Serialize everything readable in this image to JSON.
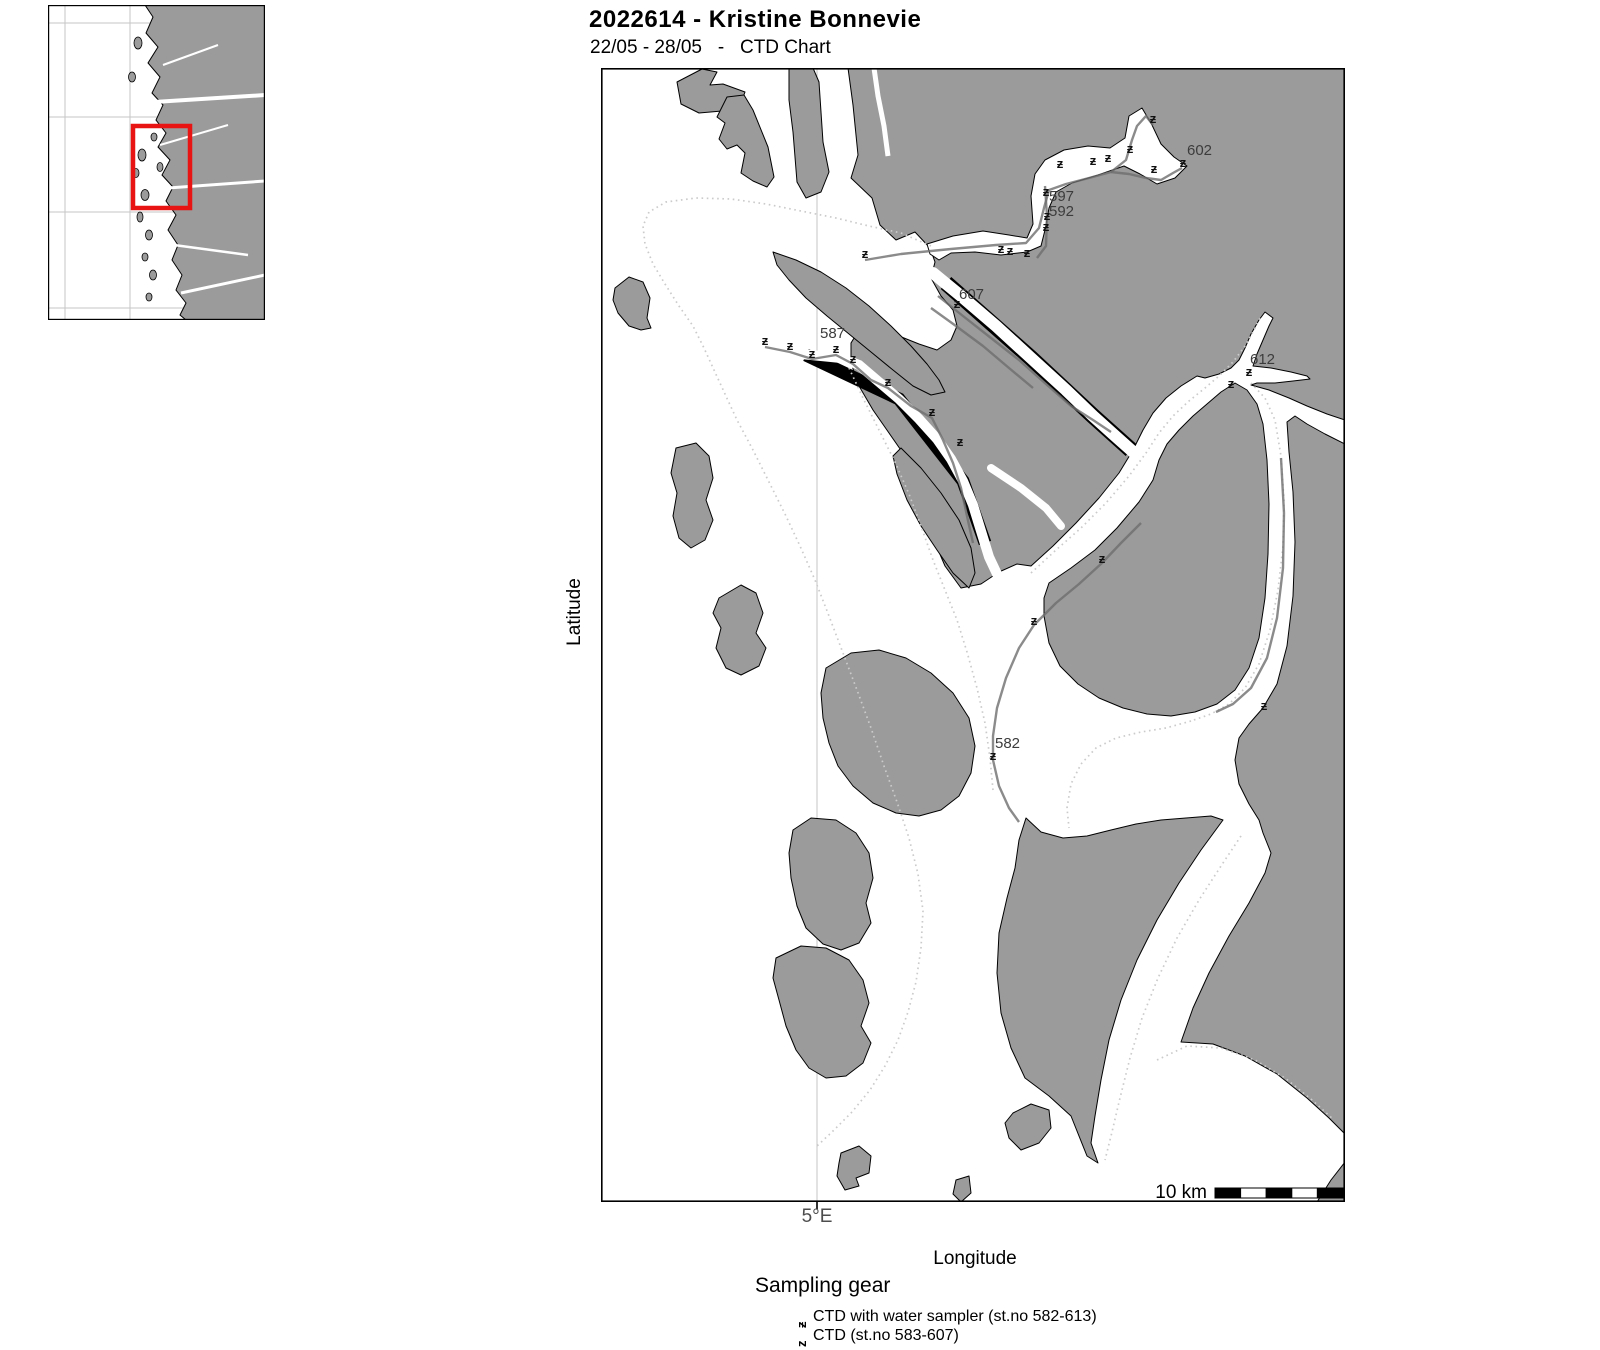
{
  "header": {
    "title": "2022614 - Kristine Bonnevie",
    "subtitle": "22/05 - 28/05   -   CTD Chart"
  },
  "axes": {
    "y_label": "Latitude",
    "x_label": "Longitude",
    "x_tick": "5°E"
  },
  "scale_bar": {
    "label": "10 km"
  },
  "legend": {
    "heading": "Sampling gear",
    "items": [
      {
        "symbol": "ƶ",
        "label": "CTD with water sampler (st.no 582-613)"
      },
      {
        "symbol": "z",
        "label": "CTD (st.no 583-607)"
      }
    ]
  },
  "map": {
    "marker_glyph": "ƶ",
    "stations": [
      [
        264,
        190
      ],
      [
        400,
        185
      ],
      [
        409,
        187
      ],
      [
        426,
        189
      ],
      [
        445,
        128
      ],
      [
        446,
        152
      ],
      [
        445,
        163
      ],
      [
        459,
        100
      ],
      [
        492,
        97
      ],
      [
        507,
        94
      ],
      [
        529,
        85
      ],
      [
        552,
        55
      ],
      [
        553,
        105
      ],
      [
        582,
        99
      ],
      [
        356,
        240
      ],
      [
        164,
        277
      ],
      [
        189,
        282
      ],
      [
        211,
        290
      ],
      [
        235,
        285
      ],
      [
        252,
        295
      ],
      [
        287,
        318
      ],
      [
        331,
        348
      ],
      [
        359,
        378
      ],
      [
        501,
        495
      ],
      [
        433,
        557
      ],
      [
        392,
        692
      ],
      [
        663,
        642
      ],
      [
        630,
        320
      ],
      [
        648,
        308
      ]
    ],
    "station_labels": [
      {
        "x": 586,
        "y": 87,
        "text": "602"
      },
      {
        "x": 448,
        "y": 133,
        "text": "597"
      },
      {
        "x": 448,
        "y": 148,
        "text": "592"
      },
      {
        "x": 358,
        "y": 231,
        "text": "607"
      },
      {
        "x": 219,
        "y": 270,
        "text": "587"
      },
      {
        "x": 649,
        "y": 296,
        "text": "612"
      },
      {
        "x": 394,
        "y": 680,
        "text": "582"
      }
    ],
    "tracks_dotted": [
      [
        [
          330,
          178
        ],
        [
          300,
          165
        ],
        [
          268,
          158
        ],
        [
          235,
          150
        ],
        [
          200,
          143
        ],
        [
          165,
          136
        ],
        [
          130,
          131
        ],
        [
          95,
          130
        ],
        [
          65,
          134
        ],
        [
          48,
          144
        ],
        [
          42,
          158
        ],
        [
          44,
          176
        ],
        [
          52,
          196
        ],
        [
          64,
          216
        ],
        [
          78,
          238
        ],
        [
          92,
          258
        ],
        [
          103,
          280
        ],
        [
          113,
          302
        ],
        [
          124,
          326
        ],
        [
          136,
          352
        ],
        [
          152,
          382
        ],
        [
          168,
          414
        ],
        [
          184,
          446
        ],
        [
          199,
          478
        ],
        [
          214,
          512
        ],
        [
          228,
          548
        ],
        [
          242,
          585
        ],
        [
          256,
          622
        ],
        [
          270,
          660
        ],
        [
          283,
          698
        ],
        [
          296,
          734
        ],
        [
          308,
          770
        ],
        [
          317,
          806
        ],
        [
          322,
          843
        ],
        [
          320,
          880
        ],
        [
          315,
          914
        ],
        [
          307,
          944
        ],
        [
          297,
          972
        ],
        [
          284,
          998
        ],
        [
          269,
          1022
        ],
        [
          251,
          1044
        ],
        [
          231,
          1064
        ],
        [
          216,
          1078
        ]
      ],
      [
        [
          248,
          300
        ],
        [
          262,
          330
        ],
        [
          278,
          362
        ],
        [
          294,
          394
        ],
        [
          308,
          426
        ],
        [
          320,
          458
        ],
        [
          332,
          492
        ],
        [
          344,
          522
        ],
        [
          356,
          552
        ],
        [
          366,
          584
        ],
        [
          376,
          620
        ],
        [
          384,
          655
        ],
        [
          389,
          690
        ],
        [
          392,
          722
        ]
      ],
      [
        [
          430,
          505
        ],
        [
          455,
          482
        ],
        [
          480,
          460
        ],
        [
          505,
          435
        ],
        [
          528,
          408
        ],
        [
          545,
          385
        ],
        [
          558,
          365
        ],
        [
          572,
          348
        ],
        [
          588,
          333
        ],
        [
          604,
          320
        ],
        [
          618,
          308
        ],
        [
          632,
          294
        ],
        [
          644,
          278
        ],
        [
          653,
          262
        ],
        [
          660,
          248
        ]
      ],
      [
        [
          650,
          315
        ],
        [
          664,
          330
        ],
        [
          674,
          352
        ],
        [
          680,
          388
        ],
        [
          683,
          432
        ],
        [
          682,
          478
        ],
        [
          677,
          522
        ],
        [
          669,
          562
        ],
        [
          658,
          596
        ],
        [
          644,
          620
        ],
        [
          628,
          636
        ],
        [
          610,
          646
        ],
        [
          590,
          653
        ]
      ],
      [
        [
          590,
          653
        ],
        [
          565,
          660
        ],
        [
          540,
          664
        ],
        [
          515,
          670
        ],
        [
          495,
          680
        ],
        [
          480,
          696
        ],
        [
          470,
          716
        ],
        [
          466,
          740
        ],
        [
          468,
          760
        ]
      ],
      [
        [
          640,
          768
        ],
        [
          620,
          798
        ],
        [
          598,
          832
        ],
        [
          576,
          870
        ],
        [
          557,
          910
        ],
        [
          541,
          950
        ],
        [
          529,
          990
        ],
        [
          519,
          1030
        ],
        [
          511,
          1064
        ],
        [
          504,
          1092
        ]
      ],
      [
        [
          556,
          992
        ],
        [
          586,
          978
        ],
        [
          620,
          980
        ],
        [
          654,
          992
        ],
        [
          684,
          1010
        ],
        [
          711,
          1032
        ],
        [
          733,
          1052
        ]
      ]
    ],
    "tracks_solid": [
      [
        [
          264,
          192
        ],
        [
          300,
          186
        ],
        [
          350,
          181
        ],
        [
          395,
          177
        ],
        [
          425,
          175
        ],
        [
          438,
          160
        ],
        [
          443,
          140
        ],
        [
          448,
          122
        ],
        [
          465,
          116
        ],
        [
          488,
          110
        ],
        [
          510,
          104
        ],
        [
          525,
          92
        ],
        [
          531,
          72
        ],
        [
          536,
          58
        ],
        [
          545,
          48
        ],
        [
          552,
          57
        ]
      ],
      [
        [
          510,
          104
        ],
        [
          528,
          106
        ],
        [
          545,
          110
        ],
        [
          560,
          112
        ],
        [
          572,
          105
        ],
        [
          581,
          100
        ]
      ],
      [
        [
          444,
          118
        ],
        [
          446,
          148
        ],
        [
          445,
          178
        ],
        [
          436,
          190
        ]
      ],
      [
        [
          164,
          279
        ],
        [
          189,
          284
        ],
        [
          211,
          291
        ],
        [
          235,
          287
        ],
        [
          252,
          296
        ],
        [
          270,
          312
        ],
        [
          287,
          320
        ],
        [
          310,
          338
        ],
        [
          331,
          350
        ],
        [
          342,
          372
        ],
        [
          352,
          395
        ],
        [
          360,
          420
        ],
        [
          366,
          448
        ],
        [
          372,
          475
        ]
      ],
      [
        [
          540,
          455
        ],
        [
          520,
          475
        ],
        [
          501,
          495
        ],
        [
          478,
          516
        ],
        [
          455,
          535
        ],
        [
          433,
          557
        ],
        [
          418,
          580
        ],
        [
          405,
          610
        ],
        [
          396,
          640
        ],
        [
          392,
          668
        ],
        [
          392,
          692
        ],
        [
          398,
          718
        ],
        [
          408,
          740
        ],
        [
          418,
          754
        ]
      ],
      [
        [
          680,
          390
        ],
        [
          683,
          445
        ],
        [
          682,
          500
        ],
        [
          676,
          550
        ],
        [
          666,
          590
        ],
        [
          650,
          620
        ],
        [
          632,
          636
        ],
        [
          615,
          644
        ]
      ],
      [
        [
          337,
          228
        ],
        [
          362,
          248
        ],
        [
          390,
          270
        ],
        [
          418,
          292
        ],
        [
          445,
          316
        ],
        [
          470,
          338
        ],
        [
          492,
          352
        ],
        [
          510,
          364
        ]
      ],
      [
        [
          330,
          240
        ],
        [
          355,
          258
        ],
        [
          382,
          278
        ],
        [
          408,
          300
        ],
        [
          432,
          320
        ]
      ]
    ]
  },
  "colors": {
    "land": "#9b9b9b",
    "sea": "#ffffff",
    "coastline": "#000000",
    "graticule": "#c6c6c6",
    "track_dotted": "#cbcbcb",
    "track_solid": "#6e6e6e",
    "inset_highlight": "#e81313",
    "marker": "#111111",
    "station_label": "#3c3c3c"
  }
}
